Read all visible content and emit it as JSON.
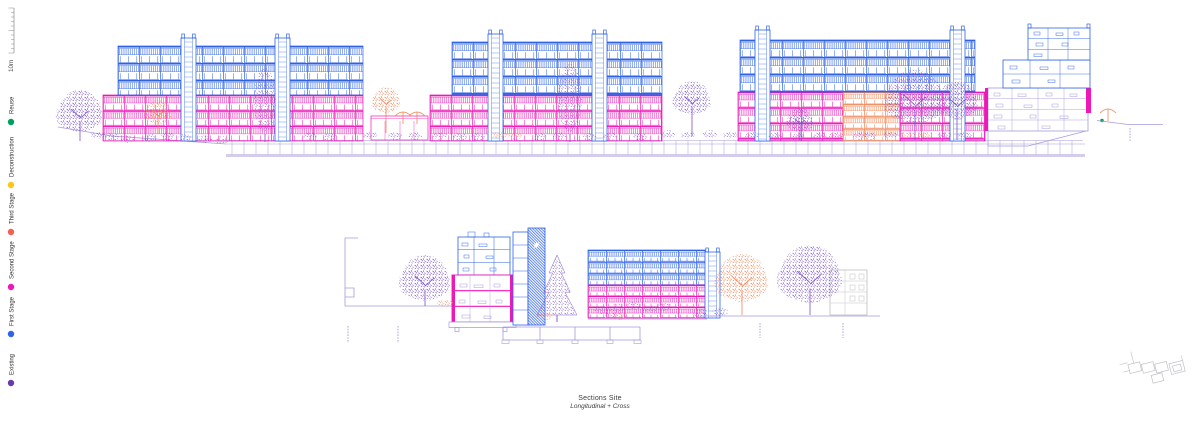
{
  "sheet": {
    "title_line1": "Sections Site",
    "title_line2": "Longitudinal + Cross"
  },
  "scale_bar": {
    "label": "10m"
  },
  "legend": {
    "items": [
      {
        "id": "reuse",
        "label": "Reuse",
        "color": "#00A05C"
      },
      {
        "id": "deconstruction",
        "label": "Deconstruction",
        "color": "#FFC61A"
      },
      {
        "id": "third-stage",
        "label": "Third Stage",
        "color": "#F2604F"
      },
      {
        "id": "second-stage",
        "label": "Second Stage",
        "color": "#EE17B7"
      },
      {
        "id": "first-stage",
        "label": "First Stage",
        "color": "#2E62E7"
      },
      {
        "id": "existing",
        "label": "Existing",
        "color": "#6A3AAB"
      }
    ]
  },
  "drawing": {
    "colors": {
      "first_stage": "#2E62E7",
      "second_stage": "#EE17B7",
      "third_stage": "#F2604F",
      "coral": "#F08455",
      "existing_purple": "#6A3AAB",
      "tree_purple": "#7B52C8",
      "line_purple": "#A89BDC",
      "context_grey": "#BFBFC7",
      "ruler_grey": "#8A8A8A",
      "green": "#00A05C",
      "yellow": "#FFC61A",
      "text": "#3C3C3C"
    }
  }
}
